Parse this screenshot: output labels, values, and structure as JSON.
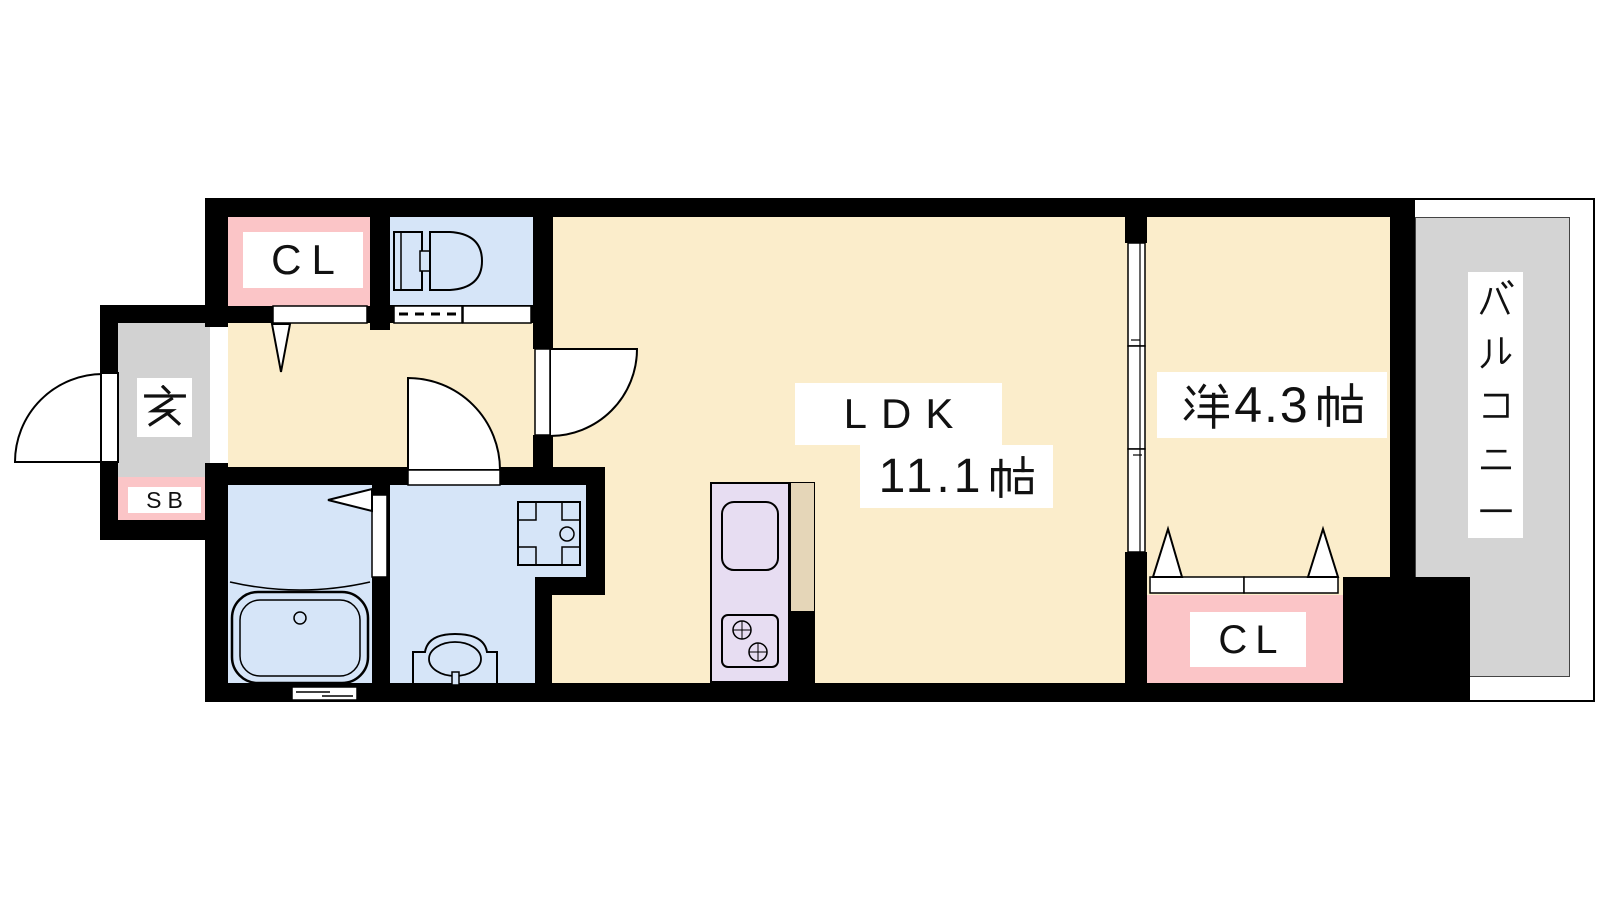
{
  "rooms": {
    "closet_top": {
      "label": "CL"
    },
    "entrance": {
      "label": "玄"
    },
    "shoe_box": {
      "label": "SB"
    },
    "ldk": {
      "name": "LDK",
      "size": "11.1",
      "unit": "帖",
      "full_label": "LDK 11.1帖"
    },
    "western_room": {
      "prefix": "洋",
      "size": "4.3",
      "unit": "帖",
      "full_label": "洋4.3帖"
    },
    "balcony": {
      "label": "バルコニー"
    },
    "closet_bottom": {
      "label": "CL"
    }
  },
  "colors": {
    "wall": "#000000",
    "floor": "#FBEDCB",
    "wet_area": "#D6E5F8",
    "closet": "#FBC5C7",
    "entrance": "#D2D2D2",
    "balcony": "#D4D4D4",
    "kitchen_counter": "#E7DDF2",
    "counter_side": "#E5D6B8",
    "door": "#FFFFFF",
    "label_text": "#111111"
  }
}
